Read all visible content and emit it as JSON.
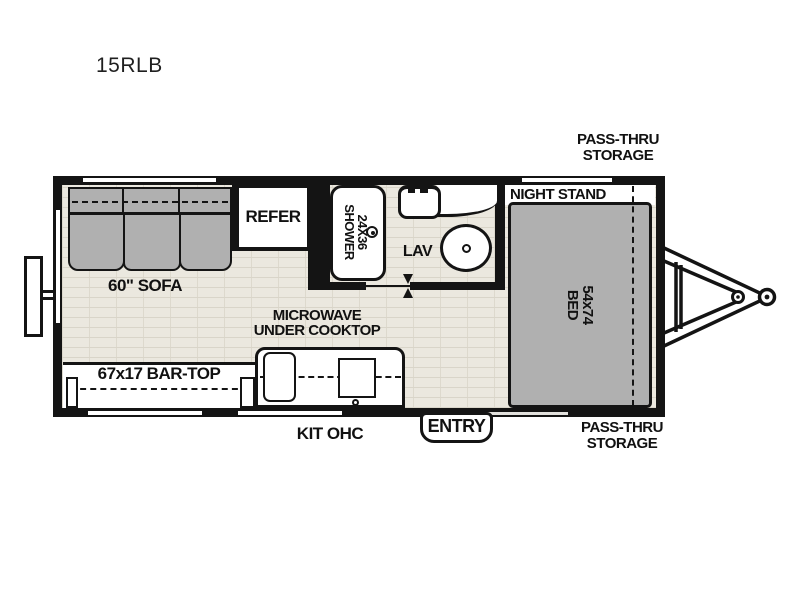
{
  "title": "15RLB",
  "exterior_labels": {
    "pass_thru_top": {
      "line1": "PASS-THRU",
      "line2": "STORAGE"
    },
    "pass_thru_bottom": {
      "line1": "PASS-THRU",
      "line2": "STORAGE"
    },
    "kit_ohc": "KIT OHC",
    "entry": "ENTRY"
  },
  "living_area": {
    "sofa": "60\" SOFA",
    "bar_top": "67x17 BAR-TOP",
    "microwave": {
      "line1": "MICROWAVE",
      "line2": "UNDER COOKTOP"
    },
    "refer": "REFER"
  },
  "bathroom": {
    "shower": {
      "line1": "24X36",
      "line2": "SHOWER"
    },
    "lav": "LAV"
  },
  "bedroom": {
    "night_stand": "NIGHT STAND",
    "bed": {
      "line1": "54x74",
      "line2": "BED"
    }
  },
  "colors": {
    "wall": "#141414",
    "furniture": "#b0b0b0",
    "floor": "#ebe8df",
    "floor_line": "#d9d5c9",
    "fixture": "#ffffff"
  }
}
